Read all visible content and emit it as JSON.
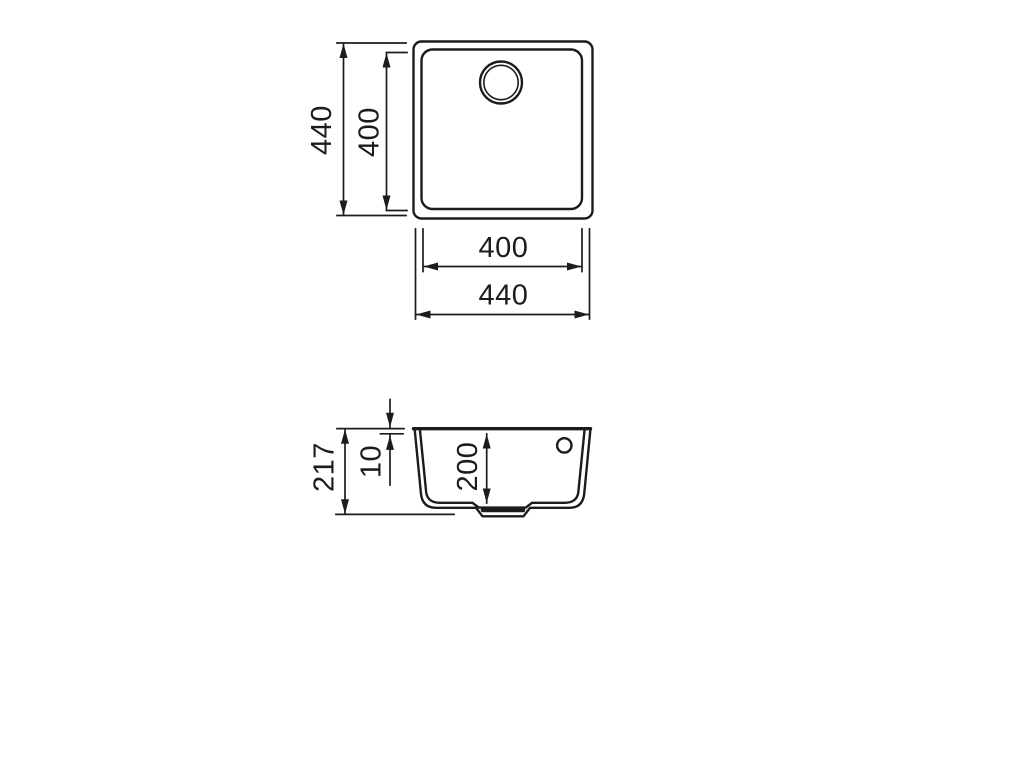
{
  "drawing": {
    "type": "technical-dimension-diagram",
    "views": {
      "top": {
        "title": "top view",
        "dimensions": {
          "outer_height": {
            "label": "440",
            "orientation": "vertical"
          },
          "inner_height": {
            "label": "400",
            "orientation": "vertical"
          },
          "inner_width": {
            "label": "400",
            "orientation": "horizontal"
          },
          "outer_width": {
            "label": "440",
            "orientation": "horizontal"
          }
        },
        "features": [
          "rounded-square-bowl",
          "drain-ring"
        ]
      },
      "side": {
        "title": "section view",
        "dimensions": {
          "total_height": {
            "label": "217",
            "orientation": "vertical"
          },
          "rim_height": {
            "label": "10",
            "orientation": "vertical"
          },
          "bowl_depth": {
            "label": "200",
            "orientation": "vertical"
          }
        },
        "features": [
          "rim-flange",
          "overflow-hole",
          "drain-recess"
        ]
      }
    },
    "colors": {
      "line": "#1c1c1c",
      "dimension": "#1c1c1c",
      "text": "#1c1c1c",
      "background": "#ffffff"
    }
  }
}
